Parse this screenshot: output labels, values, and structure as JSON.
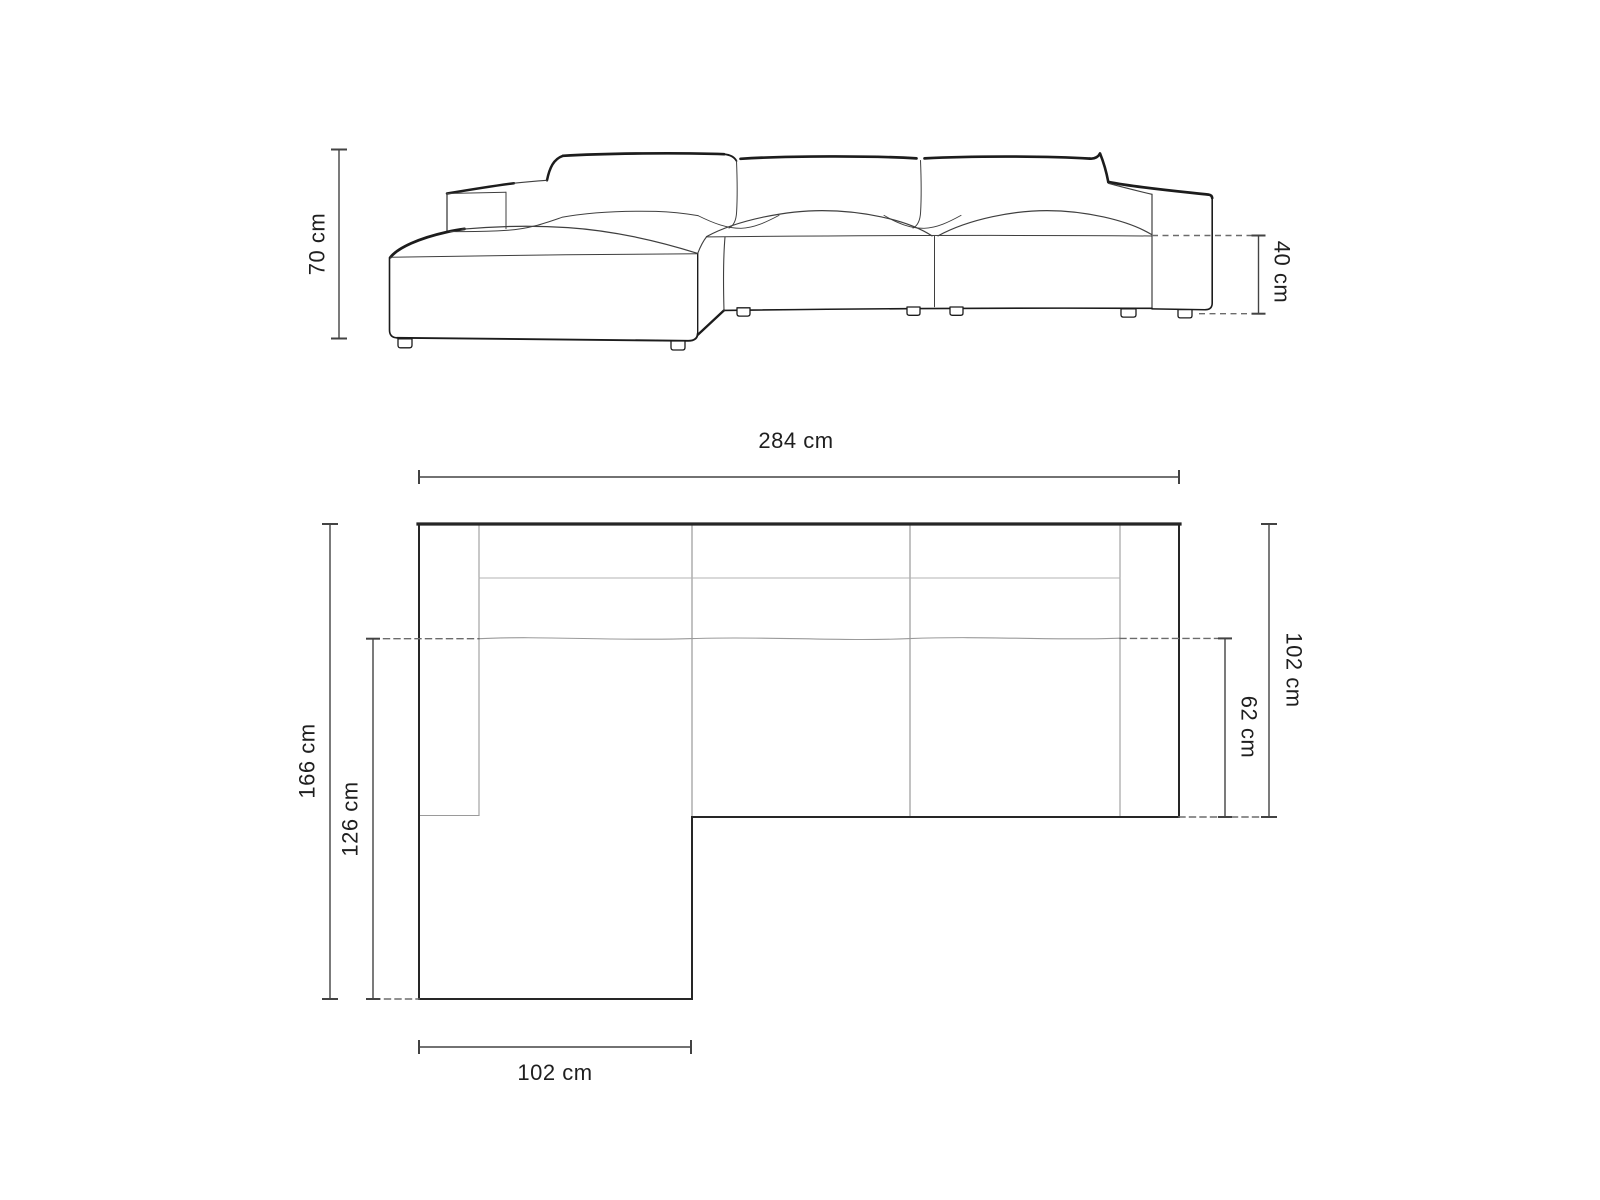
{
  "diagram": {
    "type": "furniture-dimension-drawing",
    "subject": "corner-sofa-with-left-chaise",
    "colors": {
      "background": "#ffffff",
      "outline_dark": "#1c1c1c",
      "outline_thin": "#3f3f3f",
      "plan_inner_line": "#9a9a9a",
      "plan_backrest_line": "#b3b3b3",
      "dashed_line": "#6b6b6b",
      "dimension_line": "#434343",
      "label_text": "#1f1f1f"
    },
    "front_view": {
      "name": "front elevation view",
      "labels": {
        "total_height": "70 cm",
        "seat_height": "40 cm"
      }
    },
    "top_view": {
      "name": "plan view",
      "labels": {
        "total_width": "284 cm",
        "total_depth": "166 cm",
        "chaise_depth": "126 cm",
        "right_side_depth": "102 cm",
        "seat_depth": "62 cm",
        "chaise_width": "102 cm"
      }
    },
    "dimensions": [
      {
        "name": "total height",
        "value": 70,
        "unit": "cm"
      },
      {
        "name": "seat height",
        "value": 40,
        "unit": "cm"
      },
      {
        "name": "total width",
        "value": 284,
        "unit": "cm"
      },
      {
        "name": "total depth",
        "value": 166,
        "unit": "cm"
      },
      {
        "name": "chaise depth",
        "value": 126,
        "unit": "cm"
      },
      {
        "name": "right side depth",
        "value": 102,
        "unit": "cm"
      },
      {
        "name": "seat depth",
        "value": 62,
        "unit": "cm"
      },
      {
        "name": "chaise width",
        "value": 102,
        "unit": "cm"
      }
    ]
  }
}
